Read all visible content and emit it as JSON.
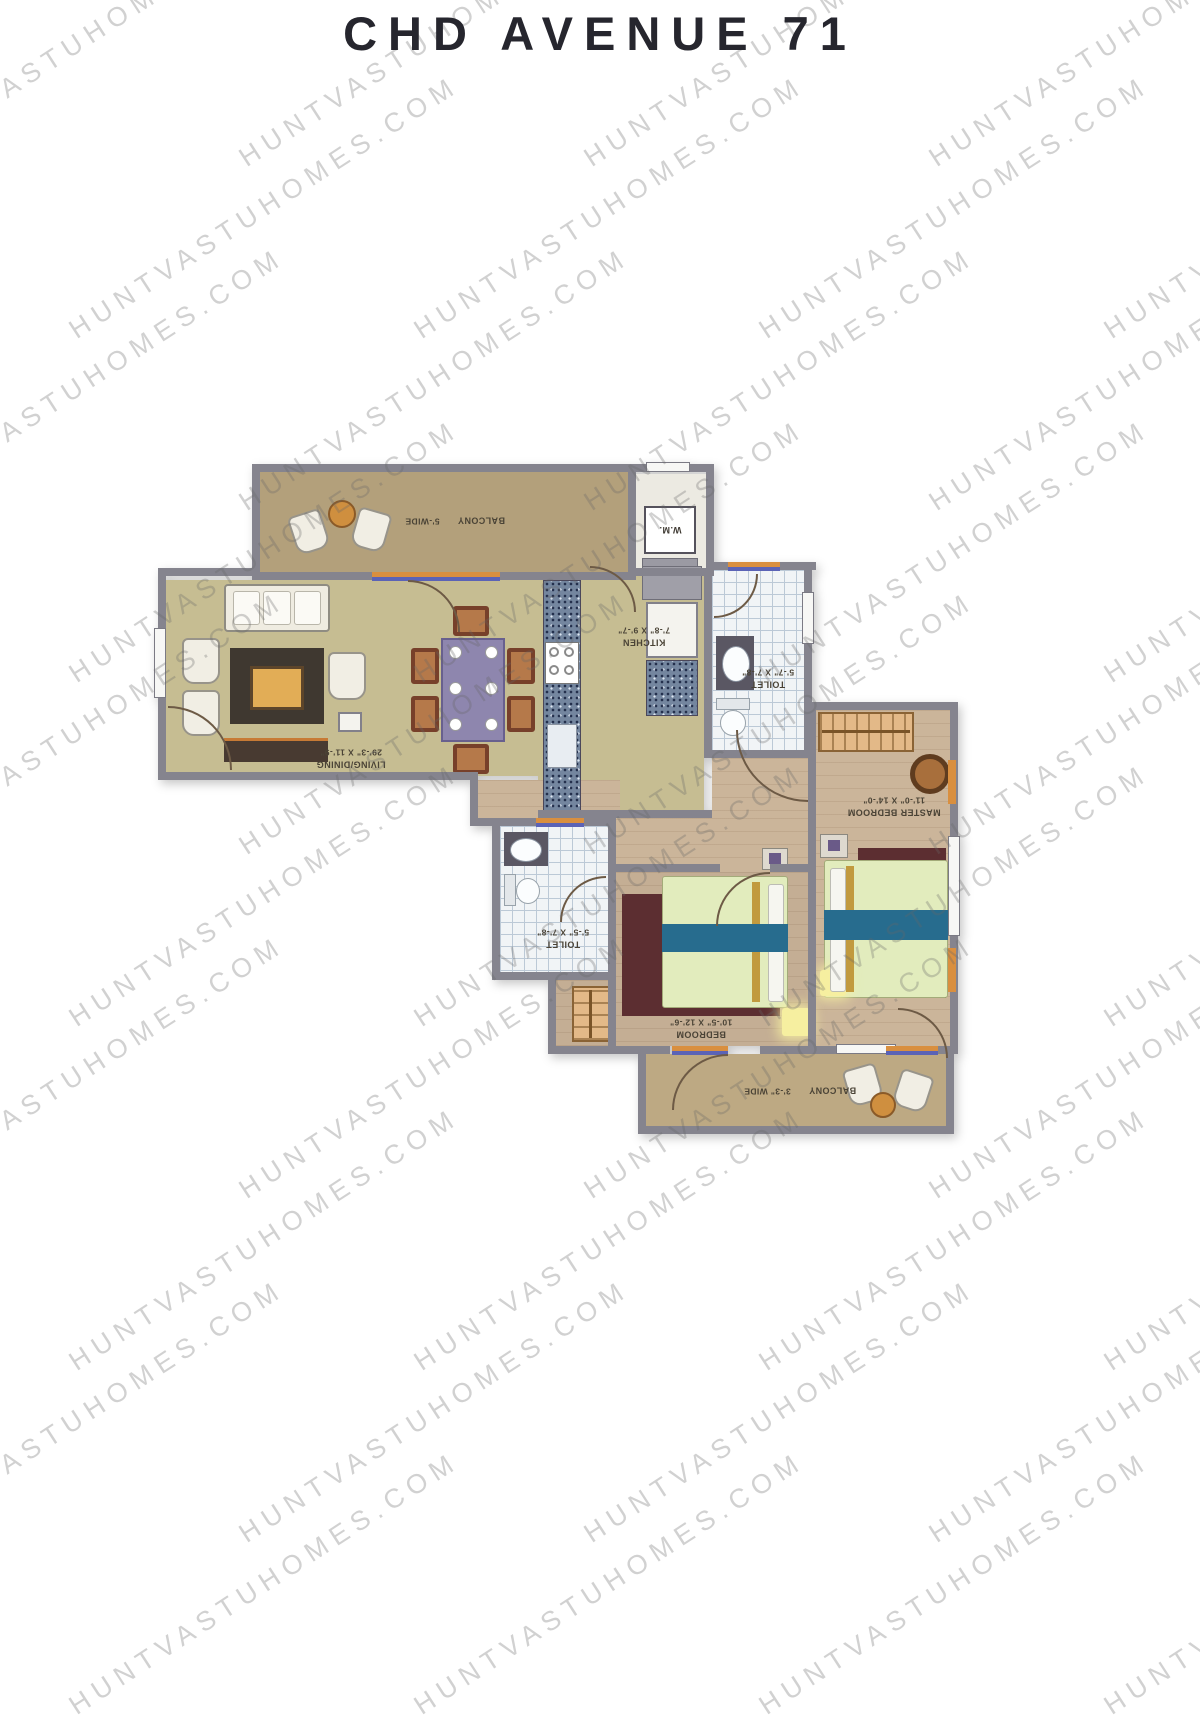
{
  "title": "CHD AVENUE 71",
  "watermark": {
    "text": "HUNTVASTUHOMES.COM"
  },
  "plan": {
    "rooms": {
      "balcony_top": {
        "name": "BALCONY",
        "dim": "5'-WIDE"
      },
      "wm": {
        "label": "W.M."
      },
      "kitchen": {
        "name": "KITCHEN",
        "dim": "7'-8\" X 9'-7\""
      },
      "toilet_top": {
        "name": "TOILET",
        "dim": "5'-7\" X 7'-8\""
      },
      "living_dining": {
        "name": "LIVING/DINING",
        "dim": "29'-3\" X 11'-9\""
      },
      "master_bedroom": {
        "name": "MASTER BEDROOM",
        "dim": "11'-0\" X 14'-0\""
      },
      "toilet_bottom": {
        "name": "TOILET",
        "dim": "5'-5\" X 7'-8\""
      },
      "bedroom": {
        "name": "BEDROOM",
        "dim": "10'-5\" X 12'-6\""
      },
      "balcony_bottom": {
        "name": "BALCONY",
        "dim": "3'-3\" WIDE"
      }
    },
    "colors": {
      "wall": "#85848e",
      "olive_floor": "#c6bd92",
      "balcony_floor": "#b3a07b",
      "wood_floor": "#cbb59a",
      "accent_orange": "#d98f3f",
      "accent_blue": "#5b63b6",
      "bed_teal": "#276c8e",
      "rug_maroon": "#5c2e31",
      "watermark_gray": "#9a9a9a",
      "title_color": "#26262e"
    }
  }
}
